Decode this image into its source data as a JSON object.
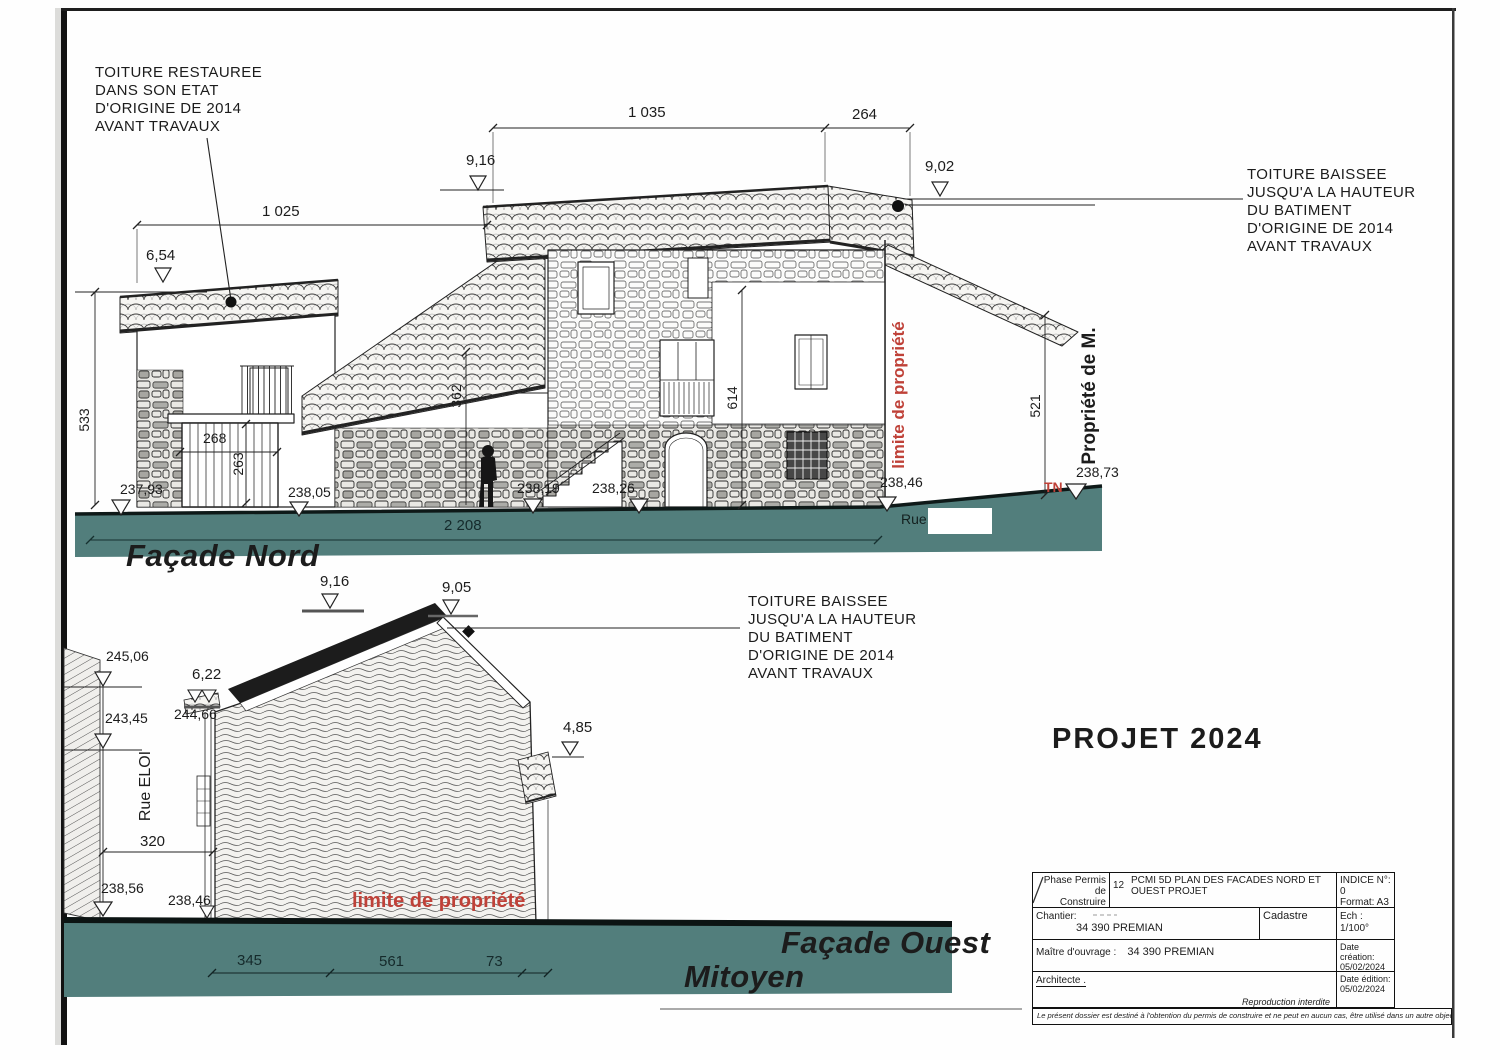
{
  "annotations": {
    "restored": [
      "TOITURE  RESTAUREE",
      "DANS SON ETAT",
      "D'ORIGINE DE 2014",
      "AVANT TRAVAUX"
    ],
    "lowered": [
      "TOITURE  BAISSEE",
      "JUSQU'A LA HAUTEUR",
      "DU BATIMENT",
      "D'ORIGINE DE 2014",
      "AVANT TRAVAUX"
    ]
  },
  "facade_nord": {
    "title": "Façade Nord",
    "dims": {
      "w_total": "1 025",
      "roof_main": "1 035",
      "roof_right": "264",
      "h_left": "533",
      "garage_w": "268",
      "garage_h": "263",
      "mid_h": "362",
      "main_h": "614",
      "right_h": "521",
      "street": "2 208"
    },
    "levels": {
      "ridge_main": "9,16",
      "ridge_right": "9,02",
      "ridge_left": "6,54"
    },
    "grounds": [
      "237,93",
      "238,05",
      "238,19",
      "238,26",
      "238,46"
    ],
    "tn": "TN",
    "ground_right": "238,73",
    "limite": "limite de propriété",
    "propriete": "Propriété de M.",
    "rue": "Rue"
  },
  "facade_ouest": {
    "title": "Façade Ouest",
    "mitoyen": "Mitoyen",
    "levels": {
      "ridge_n": "9,16",
      "ridge": "9,05",
      "wall_left_top": "245,06",
      "wall_left_mid": "243,45",
      "low_roof": "6,22",
      "low_roof_ngf": "244,66",
      "right_roof": "4,85"
    },
    "grounds": {
      "street": "238,56",
      "wall_base": "238,46"
    },
    "dims": {
      "street_w": "320",
      "seg1": "345",
      "seg2": "561",
      "seg3": "73"
    },
    "rue_eloi": "Rue ELOI",
    "limite": "limite de propriété"
  },
  "project_title": "PROJET 2024",
  "title_block": {
    "phase_line1": "Phase Permis de",
    "phase_line2": "Construire",
    "num": "12",
    "doc_title_line1": "PCMI 5D PLAN DES FACADES NORD ET",
    "doc_title_line2": "OUEST PROJET",
    "indice": "INDICE N°: 0",
    "format": "Format: A3",
    "chantier_label": "Chantier:",
    "chantier_value": "34 390 PREMIAN",
    "cadastre": "Cadastre",
    "echelle": "Ech : 1/100°",
    "moa_label": "Maître d'ouvrage :",
    "moa_value": "34 390 PREMIAN",
    "date_creation_label": "Date création:",
    "date_creation_value": "05/02/2024",
    "architecte": "Architecte .",
    "reproduction": "Reproduction interdite",
    "date_edition_label": "Date édition:",
    "date_edition_value": "05/02/2024",
    "disclaimer": "Le présent dossier est destiné à l'obtention du permis de construire et ne peut en aucun cas, être utilisé dans un autre objectif"
  },
  "colors": {
    "ground": "#527e7c",
    "annotation_red": "#bf4138"
  }
}
